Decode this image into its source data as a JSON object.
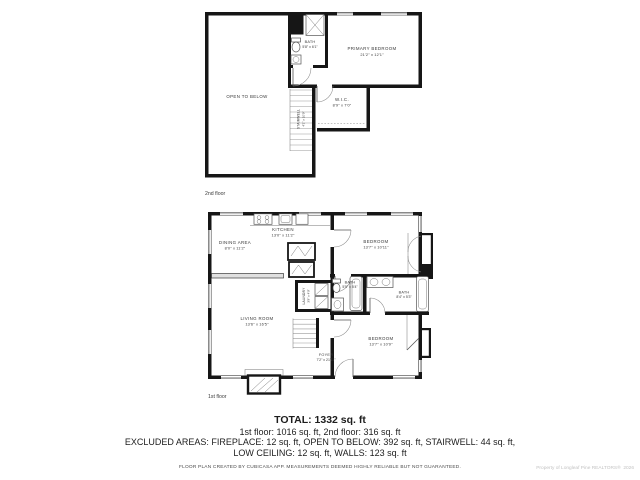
{
  "floor2": {
    "floor_label": "2nd floor",
    "rooms": {
      "open_to_below": {
        "name": "OPEN TO BELOW"
      },
      "primary_bedroom": {
        "name": "PRIMARY BEDROOM",
        "dims": "21'2\" x 12'1\""
      },
      "bath": {
        "name": "BATH",
        "dims": "5'8\" x 6'1\""
      },
      "wic": {
        "name": "W.I.C.",
        "dims": "8'9\" x 7'0\""
      },
      "stairwell": {
        "name": "STAIRWELL",
        "dims": "4'1\" x 10'9\""
      }
    }
  },
  "floor1": {
    "floor_label": "1st floor",
    "rooms": {
      "kitchen": {
        "name": "KITCHEN",
        "dims": "13'0\" x 11'2\""
      },
      "dining": {
        "name": "DINING AREA",
        "dims": "8'0\" x 11'2\""
      },
      "living": {
        "name": "LIVING ROOM",
        "dims": "13'6\" x 16'5\""
      },
      "laundry": {
        "name": "LAUNDRY",
        "dims": "3'9\" x 4'9\""
      },
      "foyer": {
        "name": "FOYER",
        "dims": "7'2\" x 21'11\""
      },
      "bedroom_top": {
        "name": "BEDROOM",
        "dims": "13'7\" x 10'11\""
      },
      "bath_center": {
        "name": "BATH",
        "dims": "5'5\" x 5'4\""
      },
      "bath_right": {
        "name": "BATH",
        "dims": "8'4\" x 5'3\""
      },
      "bedroom_bottom": {
        "name": "BEDROOM",
        "dims": "13'7\" x 10'9\""
      }
    }
  },
  "summary": {
    "total": "TOTAL: 1332 sq. ft",
    "floors": "1st floor: 1016 sq. ft, 2nd floor: 316 sq. ft",
    "excluded_line1": "EXCLUDED AREAS: FIREPLACE: 12 sq. ft, OPEN TO BELOW: 392 sq. ft, STAIRWELL: 44 sq. ft,",
    "excluded_line2": "LOW CEILING: 12 sq. ft, WALLS: 123 sq. ft"
  },
  "footer": {
    "disclaimer": "FLOOR PLAN CREATED BY CUBICASA APP. MEASUREMENTS DEEMED HIGHLY RELIABLE BUT NOT GUARANTEED.",
    "watermark": "Property of Longleaf Pine REALTORS®  2026"
  },
  "colors": {
    "wall": "#161616",
    "label": "#3a3a3a",
    "watermark": "#c3c3c3",
    "background": "#ffffff"
  }
}
